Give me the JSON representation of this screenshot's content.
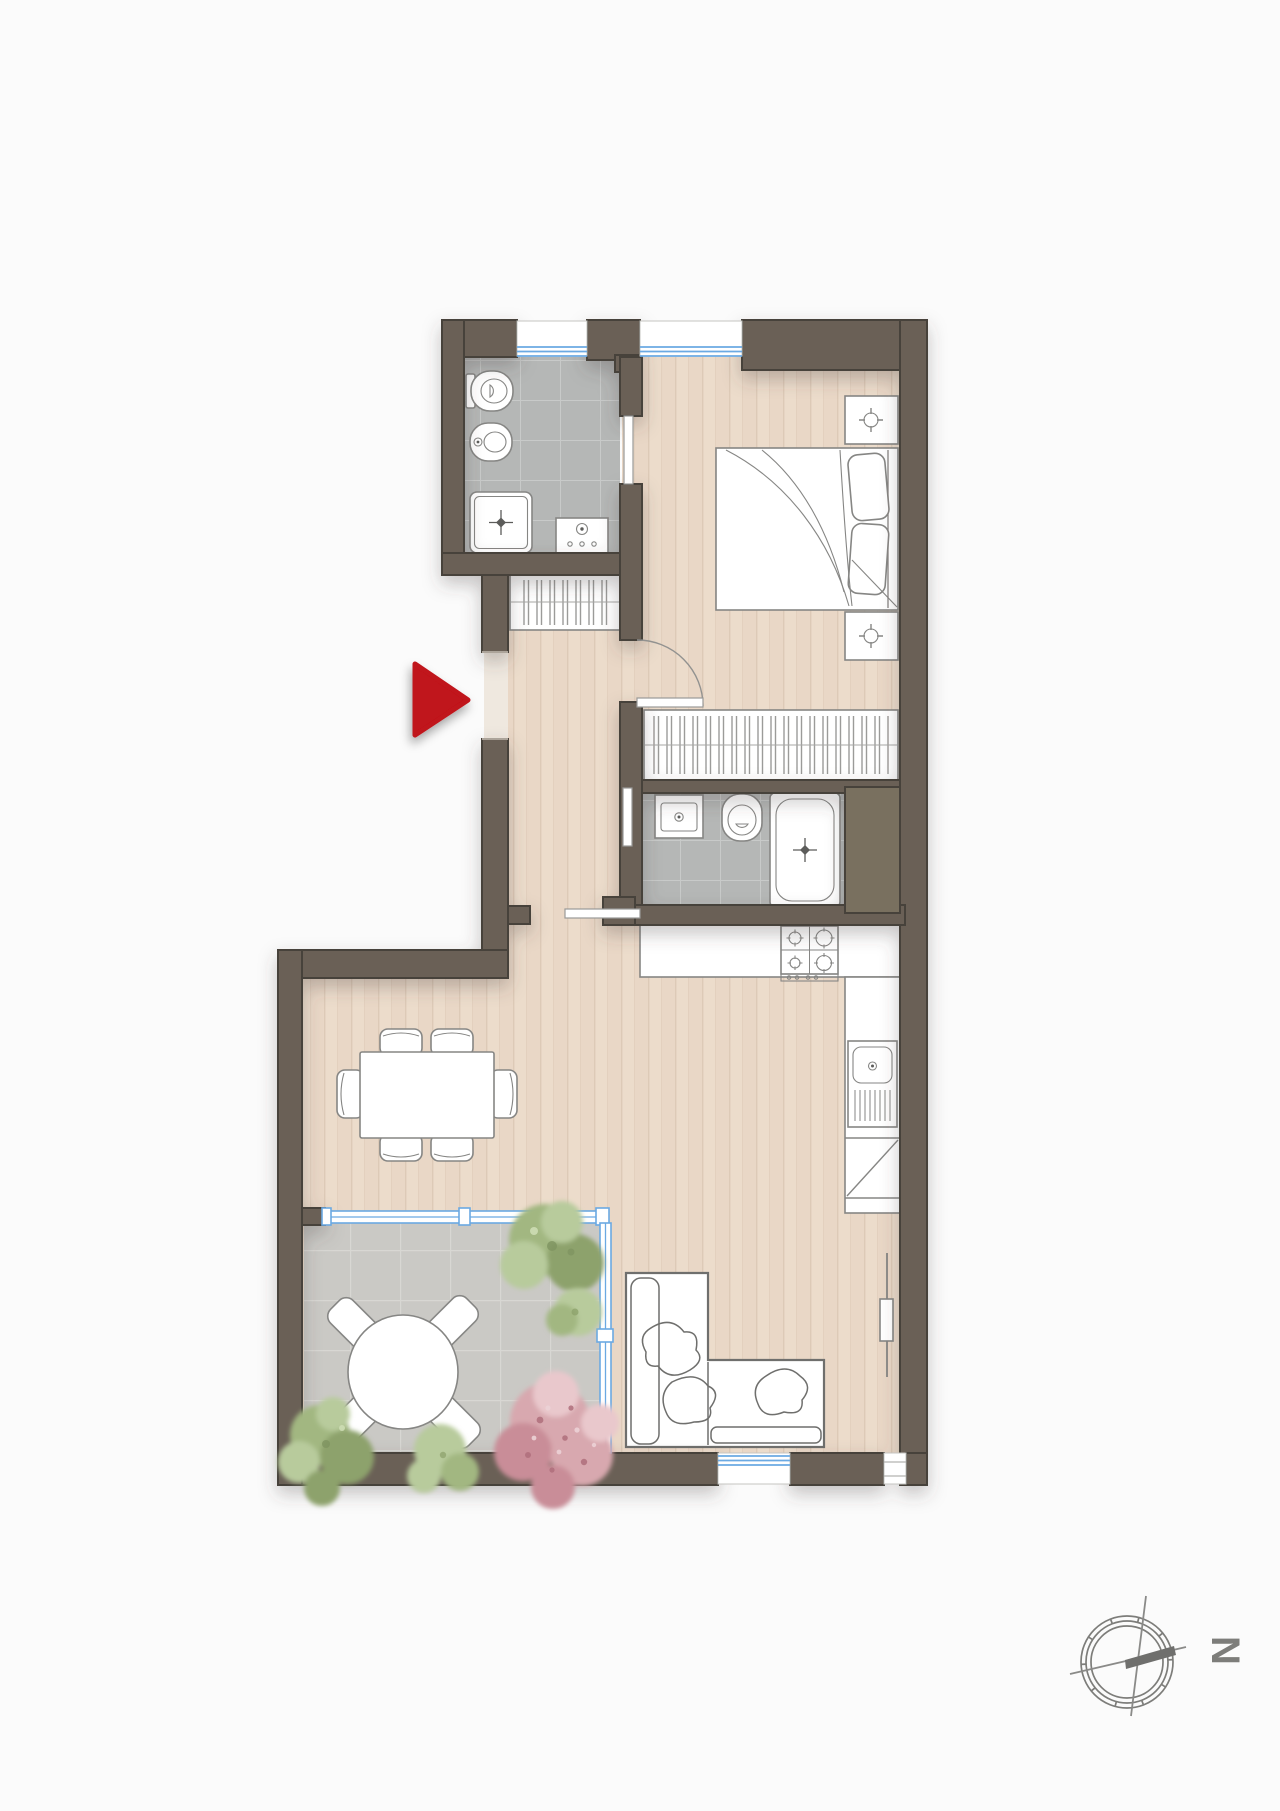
{
  "canvas": {
    "width": 1280,
    "height": 1811
  },
  "colors": {
    "bg": "#fbfbfb",
    "wall": "#6a6156",
    "wallStroke": "#46423b",
    "wallLight": "#79705f",
    "floorWood": "#ecdccb",
    "floorWoodAlt": "#e6d3c1",
    "plankLine": "#dcc8b5",
    "tileBath": "#b5b7b6",
    "tileBathLine": "#c8cac9",
    "tileTerr": "#cac9c5",
    "tileTerrLine": "#d8d7d3",
    "furnStroke": "#868684",
    "sofaStroke": "#6f6f6d",
    "drainDark": "#5c5c5a",
    "glassBlue": "#6ba9e2",
    "doorArc": "#929290",
    "arrowRed": "#c0121a",
    "compassGray": "#7d7d7a",
    "treeGreen1": "#a2b781",
    "treeGreen2": "#8da26c",
    "treeGreen3": "#b8cb9c",
    "treePink1": "#d8a8af",
    "treePink2": "#c98d98",
    "treePink3": "#e9c8cc"
  },
  "compass": {
    "label": "N",
    "rotation_deg": 90
  },
  "entrance": {
    "marker": "red-arrow",
    "direction": "right"
  },
  "plan": {
    "rooms": [
      {
        "id": "bathroom-1",
        "floor": "gray-tile",
        "fixtures": [
          "toilet",
          "bidet",
          "shower-tray",
          "washing-machine"
        ]
      },
      {
        "id": "bedroom",
        "floor": "wood",
        "furniture": [
          "double-bed",
          "nightstand",
          "nightstand",
          "wardrobe"
        ]
      },
      {
        "id": "hallway",
        "floor": "wood",
        "furniture": [
          "wardrobe"
        ]
      },
      {
        "id": "bathroom-2",
        "floor": "gray-tile",
        "fixtures": [
          "washbasin",
          "toilet",
          "bathtub"
        ]
      },
      {
        "id": "kitchen",
        "floor": "wood",
        "fixtures": [
          "gas-hob",
          "counter",
          "sink",
          "corner-cabinet",
          "radiator-column"
        ]
      },
      {
        "id": "living-dining",
        "floor": "wood",
        "furniture": [
          "dining-table",
          "dining-chairs-x6",
          "corner-sofa"
        ]
      },
      {
        "id": "terrace",
        "floor": "stone-tile",
        "furniture": [
          "round-table",
          "terrace-chairs-x4",
          "plants-x4"
        ],
        "enclosure": "glazed-wall"
      }
    ],
    "windows": {
      "top_wall": 2,
      "bottom_wall": 2
    },
    "doors": [
      "entrance-opening",
      "bedroom-swing-door",
      "bathroom-1-pocket-door",
      "bathroom-2-pocket-door",
      "living-pocket-door"
    ]
  }
}
